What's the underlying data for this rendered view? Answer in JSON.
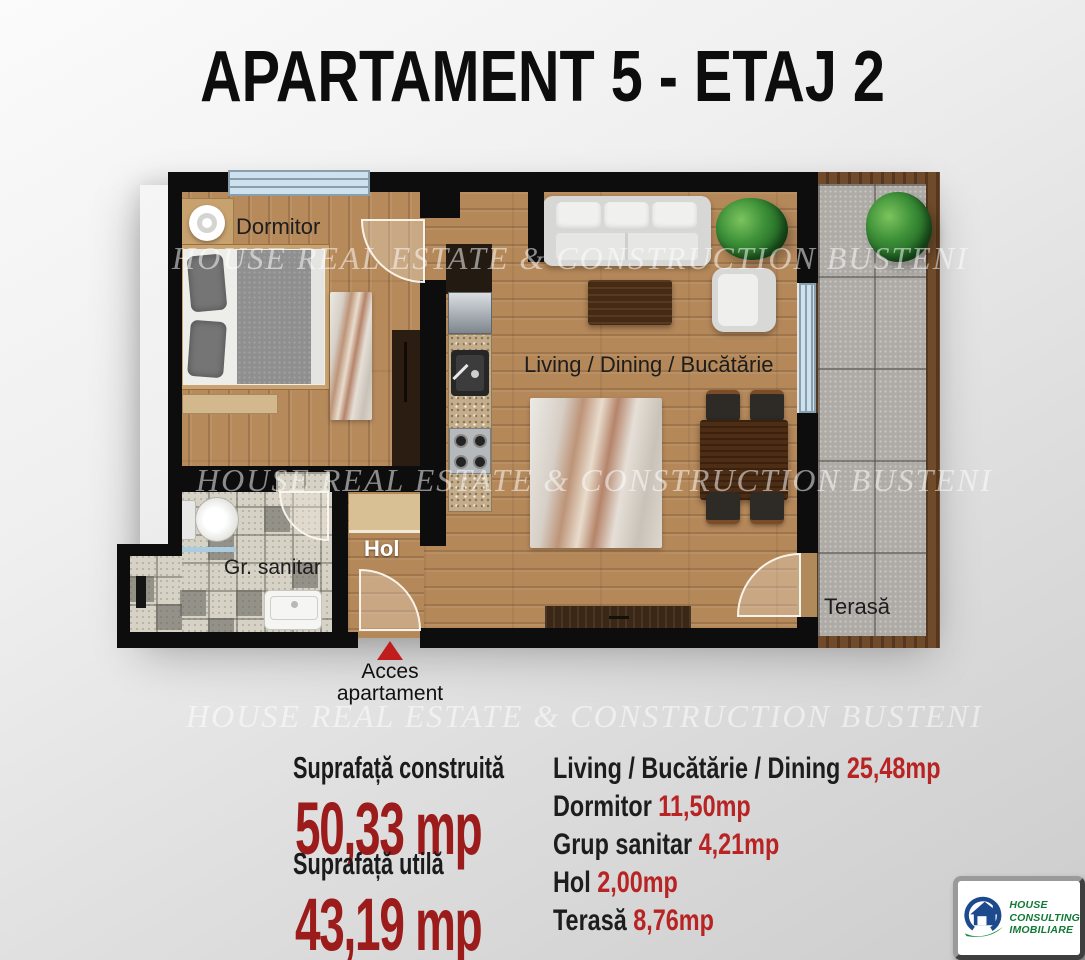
{
  "title": "APARTAMENT 5 - ETAJ 2",
  "watermark": "HOUSE REAL ESTATE & CONSTRUCTION BUSTENI",
  "plan": {
    "labels": {
      "bedroom": "Dormitor",
      "living": "Living / Dining / Bucătărie",
      "bathroom": "Gr. sanitar",
      "hallway": "Hol",
      "terrace": "Terasă"
    },
    "access": {
      "line1": "Acces",
      "line2": "apartament"
    }
  },
  "summary": {
    "built_label": "Suprafață construită",
    "built_value": "50,33 mp",
    "usable_label": "Suprafață utilă",
    "usable_value": "43,19 mp",
    "rooms": [
      {
        "name": "Living / Bucătărie / Dining",
        "value": "25,48mp"
      },
      {
        "name": "Dormitor",
        "value": "11,50mp"
      },
      {
        "name": "Grup sanitar",
        "value": "4,21mp"
      },
      {
        "name": "Hol",
        "value": "2,00mp"
      },
      {
        "name": "Terasă",
        "value": "8,76mp"
      }
    ]
  },
  "logo": {
    "line1": "HOUSE",
    "line2": "CONSULTING",
    "line3": "IMOBILIARE"
  },
  "colors": {
    "accent_red": "#9c1b1b",
    "list_value_red": "#b82323",
    "wall_black": "#0d0d0d",
    "wood_floor": "#b5885a",
    "terrace_tile_gray": "#aeaba6",
    "window_blue": "#cde1ee",
    "logo_blue": "#1c4a8c",
    "logo_green": "#128a3a"
  }
}
